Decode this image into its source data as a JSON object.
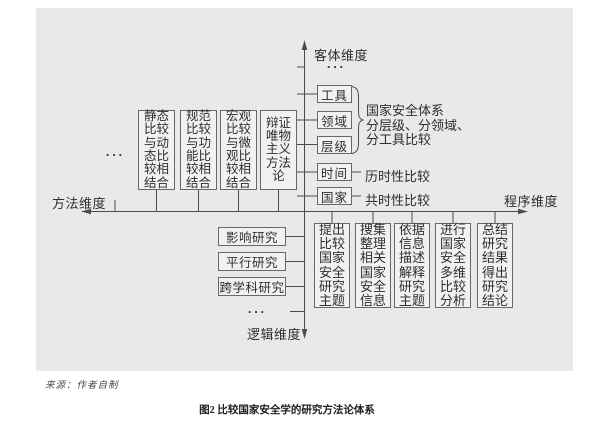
{
  "figure": {
    "caption": "图2 比较国家安全学的研究方法论体系",
    "source_note": "来源：作者自制"
  },
  "axes": {
    "top_label": "客体维度",
    "right_label": "程序维度",
    "bottom_label": "逻辑维度",
    "left_label": "方法维度"
  },
  "object_dimension": {
    "ellipsis": "···",
    "boxes": [
      "工具",
      "领域",
      "层级",
      "时间",
      "国家"
    ],
    "group_annotation_lines": [
      "国家安全体系",
      "分层级、分领域、",
      "分工具比较"
    ],
    "time_annotation": "历时性比较",
    "country_annotation": "共时性比较"
  },
  "method_dimension": {
    "ellipsis": "···",
    "boxes": [
      "静态比较与动态比较相结合",
      "规范比较与功能比较相结合",
      "宏观比较与微观比较相结合",
      "辩证唯物主义方法论"
    ]
  },
  "logic_dimension": {
    "ellipsis": "···",
    "boxes": [
      "影响研究",
      "平行研究",
      "跨学科研究"
    ]
  },
  "procedure_dimension": {
    "boxes": [
      "提出比较国家安全研究主题",
      "搜集整理相关国家安全信息",
      "依据信息描述解释研究主题",
      "进行国家安全多维比较分析",
      "总结研究结果得出研究结论"
    ]
  },
  "colors": {
    "panel_bg": "#e8e9eb",
    "box_fill": "#f0f1f3",
    "box_border": "#686868",
    "line": "#4c4c4c",
    "text": "#2e2e2e"
  }
}
